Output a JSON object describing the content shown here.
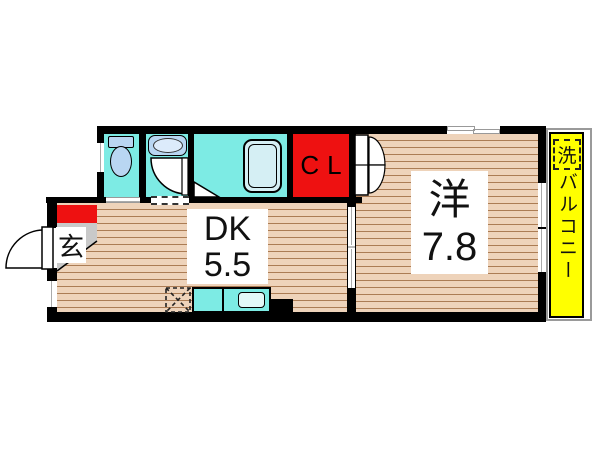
{
  "plan": {
    "title": "1DK apartment floor plan",
    "rooms": {
      "dining_kitchen": {
        "label": "DK",
        "size": "5.5"
      },
      "western_room": {
        "label": "洋",
        "size": "7.8"
      },
      "closet": {
        "label": "CL"
      },
      "entrance": {
        "label": "玄"
      },
      "balcony": {
        "label": "バルコニー"
      },
      "laundry": {
        "label": "洗"
      }
    },
    "colors": {
      "wall": "#000000",
      "water_area_cyan": "#7debe4",
      "closet_red": "#ee1111",
      "balcony_yellow": "#ffff00",
      "wood_floor": "#eed3ba",
      "wood_line": "#ab7c54",
      "fixture_blue": "#b9d6f2",
      "bathtub_fill": "#d5eff4",
      "entrance_gray": "#c9c9c9",
      "balcony_outline_gray": "#9a9a9a"
    }
  }
}
